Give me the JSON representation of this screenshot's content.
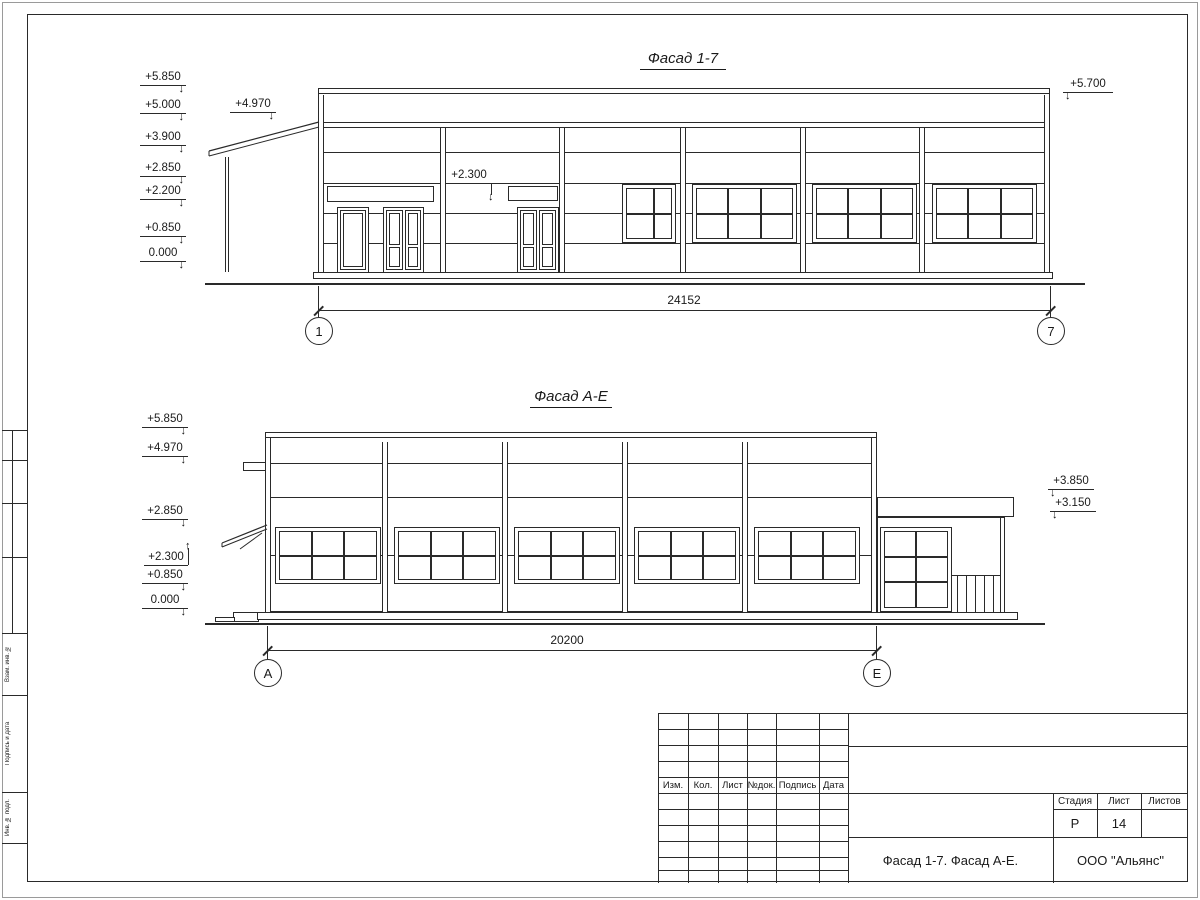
{
  "facade1": {
    "title": "Фасад 1-7",
    "marks": {
      "m5850": "+5.850",
      "m5000": "+5.000",
      "m3900": "+3.900",
      "m2850": "+2.850",
      "m2200": "+2.200",
      "m0850": "+0.850",
      "m0000": "0.000",
      "m4970": "+4.970",
      "m2300": "+2.300",
      "m5700": "+5.700"
    },
    "dim": "24152",
    "axis_left": "1",
    "axis_right": "7"
  },
  "facade2": {
    "title": "Фасад А-Е",
    "marks": {
      "m5850": "+5.850",
      "m4970": "+4.970",
      "m2850": "+2.850",
      "m2300": "+2.300",
      "m0850": "+0.850",
      "m0000": "0.000",
      "m3850": "+3.850",
      "m3150": "+3.150"
    },
    "dim": "20200",
    "axis_left": "А",
    "axis_right": "Е"
  },
  "titleblock": {
    "col1": "Изм.",
    "col2": "Кол.",
    "col3": "Лист",
    "col4": "№док.",
    "col5": "Подпись",
    "col6": "Дата",
    "stage_label": "Стадия",
    "sheet_label": "Лист",
    "sheets_label": "Листов",
    "stage_value": "Р",
    "sheet_value": "14",
    "doc_title": "Фасад 1-7. Фасад А-Е.",
    "company": "ООО \"Альянс\""
  },
  "sidestamp": {
    "s1": "Взам. инв. №",
    "s2": "Подпись и дата",
    "s3": "Инв. № подл."
  }
}
